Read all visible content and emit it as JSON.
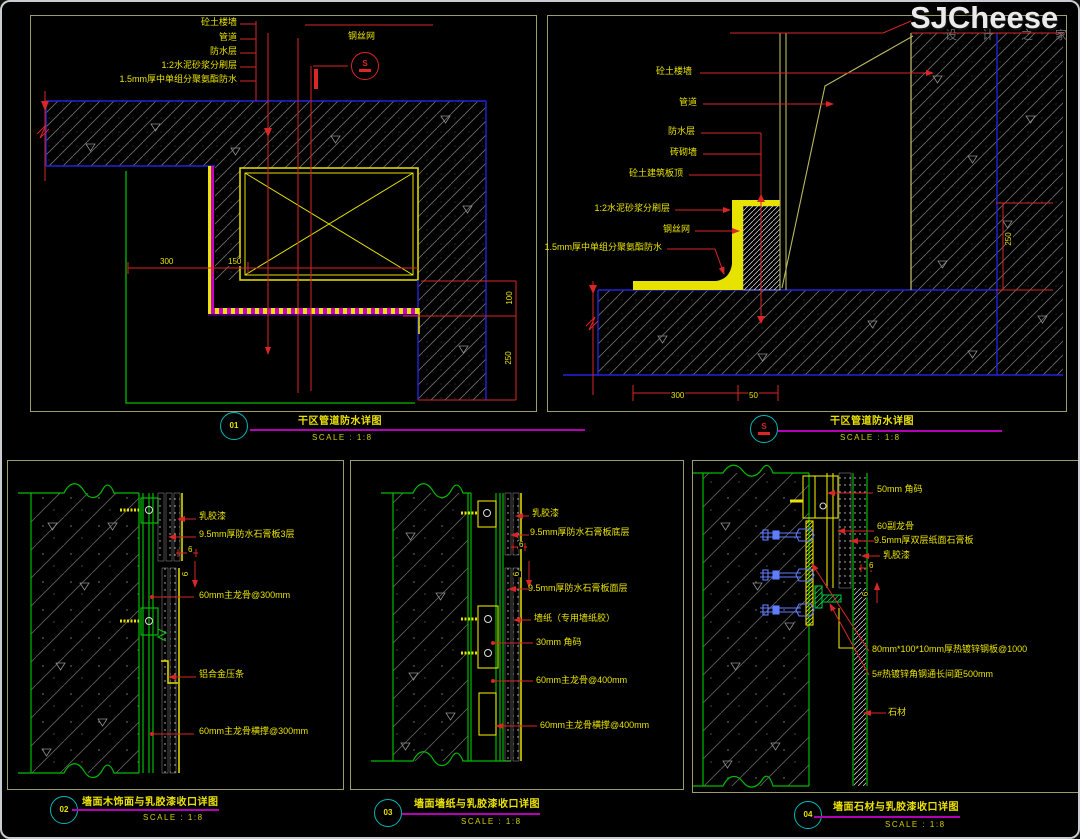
{
  "watermark": {
    "brand": "SJCheese",
    "sub": [
      "设",
      "计",
      "之",
      "家"
    ]
  },
  "detail1": {
    "id": "01",
    "callout_id": "S",
    "title": "干区管道防水详图",
    "scale": "SCALE : 1:8",
    "labels": {
      "l1": "砼土楼墙",
      "l2": "管道",
      "l3": "防水层",
      "l4": "1:2水泥砂浆分刷层",
      "l5": "1.5mm厚中单组分聚氨酯防水",
      "l6": "钢丝网"
    },
    "dims": {
      "d1": "300",
      "d2": "150",
      "d3": "100",
      "d4": "250"
    }
  },
  "detailS": {
    "id": "S",
    "title": "干区管道防水详图",
    "scale": "SCALE : 1:8",
    "labels": {
      "l1": "砼土楼墙",
      "l2": "管道",
      "l3": "防水层",
      "l4": "砖砌墙",
      "l5": "砼土建筑板顶",
      "l6": "1:2水泥砂浆分刷层",
      "l7": "钢丝网",
      "l8": "1.5mm厚中单组分聚氨酯防水"
    },
    "dims": {
      "d1": "250",
      "d2": "300",
      "d3": "50"
    }
  },
  "detail2": {
    "id": "02",
    "title": "墙面木饰面与乳胶漆收口详图",
    "scale": "SCALE : 1:8",
    "labels": {
      "l1": "乳胶漆",
      "l2": "9.5mm厚防水石膏板3层",
      "l3": "60mm主龙骨@300mm",
      "l4": "铝合金压条",
      "l5": "60mm主龙骨横撑@300mm"
    },
    "dims": {
      "d1": "6",
      "d2": "6"
    }
  },
  "detail3": {
    "id": "03",
    "title": "墙面墙纸与乳胶漆收口详图",
    "scale": "SCALE : 1:8",
    "labels": {
      "l1": "乳胶漆",
      "l2": "9.5mm厚防水石膏板底层",
      "l3": "9.5mm厚防水石膏板面层",
      "l4": "墙纸（专用墙纸胶）",
      "l5": "30mm 角码",
      "l6": "60mm主龙骨@400mm",
      "l7": "60mm主龙骨横撑@400mm"
    },
    "dims": {
      "d1": "6",
      "d2": "6"
    }
  },
  "detail4": {
    "id": "04",
    "title": "墙面石材与乳胶漆收口详图",
    "scale": "SCALE : 1:8",
    "labels": {
      "l1": "50mm 角码",
      "l2": "60副龙骨",
      "l3": "9.5mm厚双层纸面石膏板",
      "l4": "乳胶漆",
      "l5": "80mm*100*10mm厚热镀锌钢板@1000",
      "l6": "5#热镀锌角钢通长间距500mm",
      "l7": "石材"
    },
    "dims": {
      "d1": "6",
      "d2": "6"
    }
  }
}
